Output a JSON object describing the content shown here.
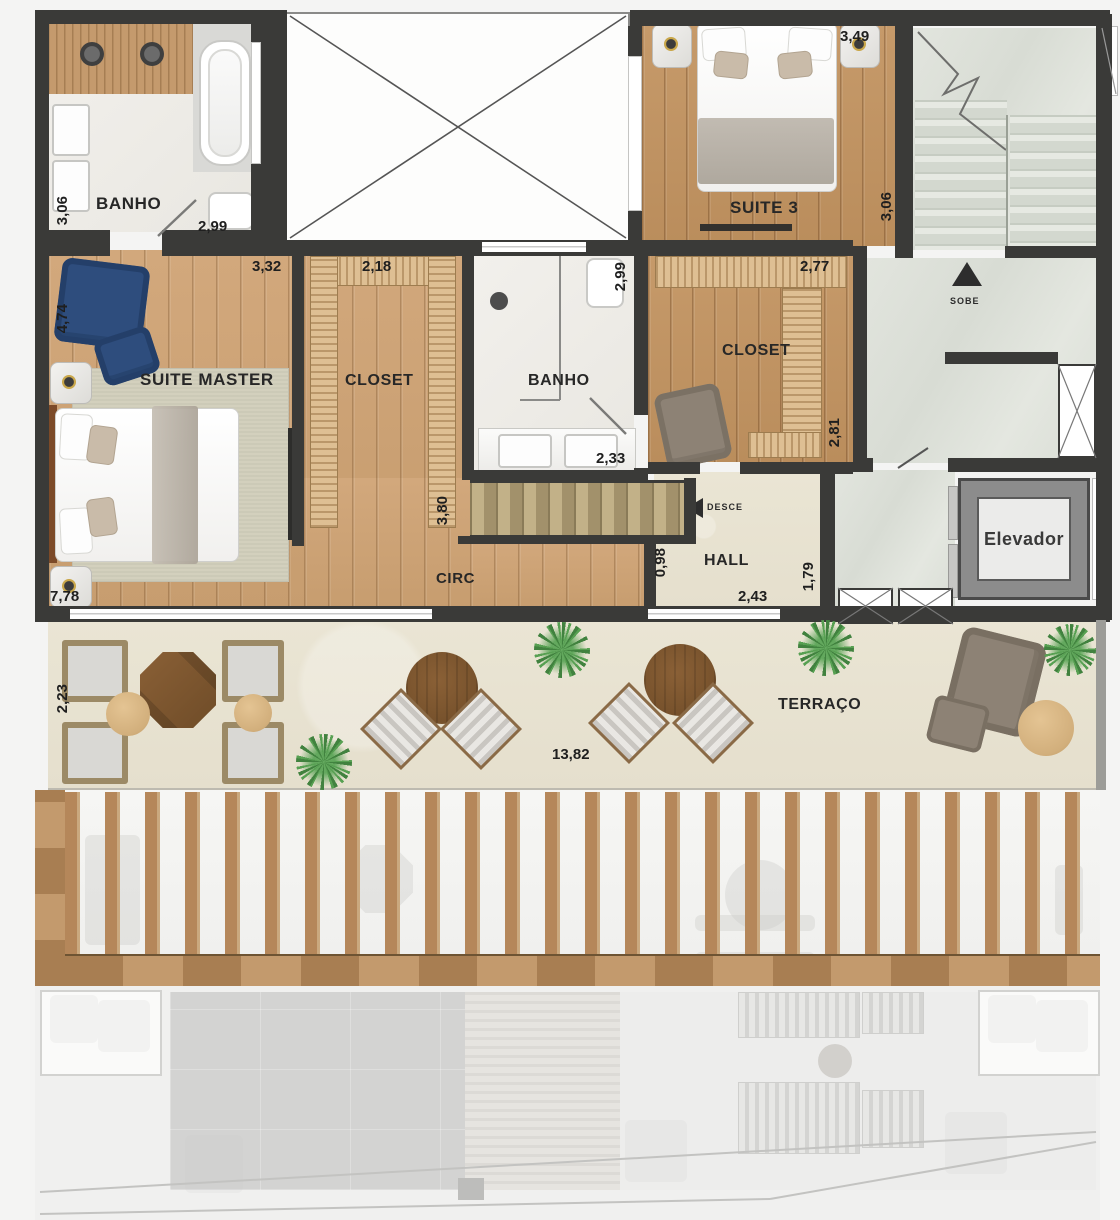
{
  "rooms": {
    "banho_master": {
      "label": "BANHO",
      "dim_left": "3,06",
      "dim_bottom": "2,99"
    },
    "suite_master": {
      "label": "SUITE MASTER",
      "dim_top": "3,32",
      "dim_left": "4,74",
      "dim_bottom": "7,78"
    },
    "closet_master": {
      "label": "CLOSET",
      "dim_top": "2,18",
      "dim_right": "3,80"
    },
    "banho_suite": {
      "label": "BANHO",
      "dim_right": "2,99",
      "dim_bottom": "2,33"
    },
    "suite3": {
      "label": "SUITE 3",
      "dim_top": "3,49",
      "dim_right": "3,06"
    },
    "closet_suite3": {
      "label": "CLOSET",
      "dim_top": "2,77",
      "dim_right": "2,81"
    },
    "circ": {
      "label": "CIRC"
    },
    "hall": {
      "label": "HALL",
      "dim_left": "0,98",
      "dim_bottom": "2,43",
      "dim_right": "1,79"
    },
    "terraco": {
      "label": "TERRAÇO",
      "dim_left": "2,23",
      "dim_bottom": "13,82"
    },
    "elevador": {
      "label": "Elevador"
    },
    "stairs": {
      "up": "SOBE",
      "down": "DESCE"
    }
  },
  "colors": {
    "wall": "#3a3a38",
    "wood": "#d2a87c",
    "wood_dark": "#c69a6a",
    "marble": "#dfe2db",
    "terrace_stone": "#e9e4d4",
    "accent_blue": "#2e4d7d"
  }
}
